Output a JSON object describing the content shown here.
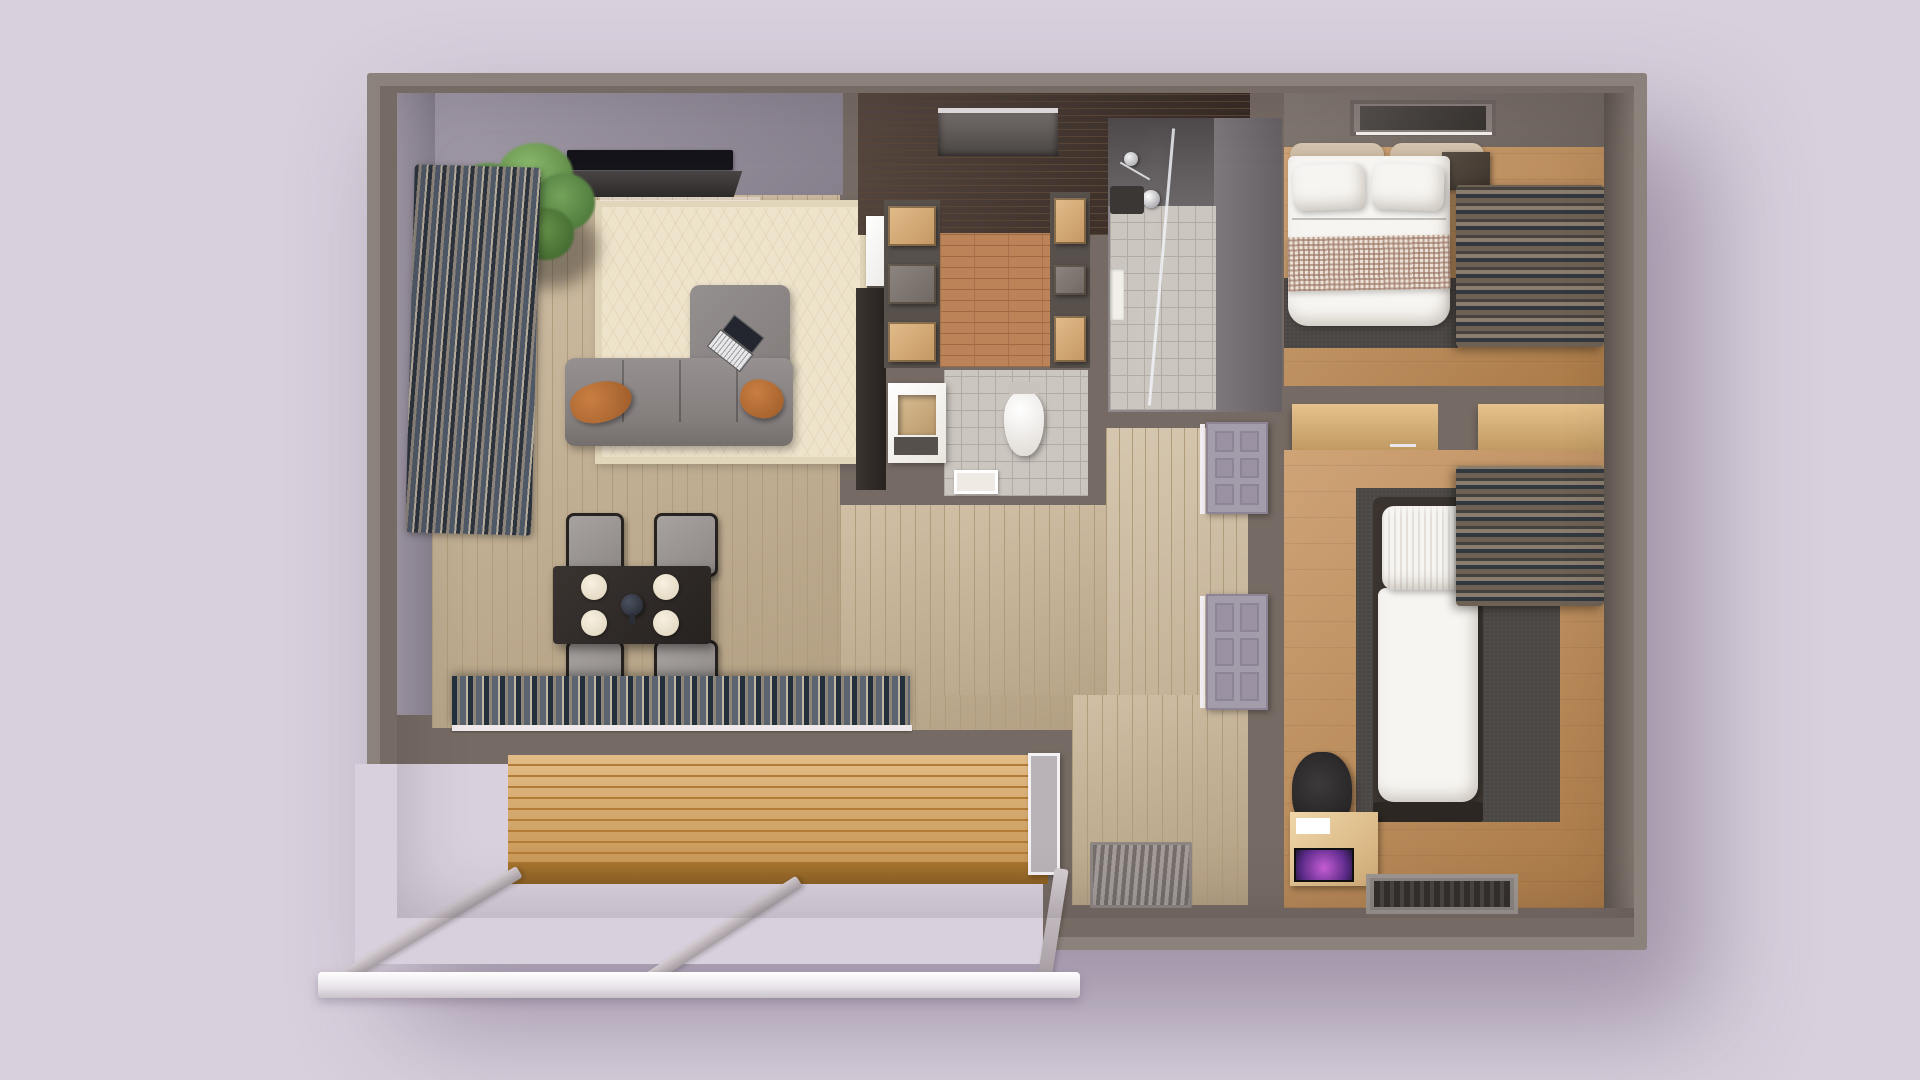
{
  "scene": {
    "type": "3d-floor-plan-render",
    "view": "top-down",
    "description": "Photorealistic top-down 3D render of a small apartment floor plan with wooden deck",
    "text_labels": []
  },
  "palette": {
    "bg": "#d8d0dc",
    "wall": "#766b64",
    "wallFaceLight": "#a59dab",
    "wallFaceDark": "#867f8c",
    "woodLight": "#c6b191",
    "woodLightLine": "#b09b7b",
    "woodDark": "#43332b",
    "woodDarkLine": "#5a4636",
    "brick": "#bc8258",
    "brickLine": "#9d6a41",
    "oak": "#c18a50",
    "tile": "#ccc6c0",
    "tileGrid": "#b2aba4",
    "rug": "#eee3cb",
    "rugBorder": "#e2d6ba",
    "sofa": "#8b8584",
    "pillowOrange": "#b06a33",
    "tableDark": "#2f2a27",
    "carpet": "#4b4744",
    "bedWhite": "#f7f5f1",
    "cushionTan": "#cfbda6",
    "deck": "#d9a55e",
    "deckGroove": "#b27c36",
    "railWhite": "#f5f2f6",
    "screenPurple": "#8b3fa8"
  },
  "rooms": [
    {
      "id": "living-dining",
      "name": "living and dining room"
    },
    {
      "id": "entry-hall",
      "name": "entry hall"
    },
    {
      "id": "kitchen",
      "name": "galley kitchen"
    },
    {
      "id": "shower-room",
      "name": "shower room"
    },
    {
      "id": "wc",
      "name": "toilet room"
    },
    {
      "id": "hallway",
      "name": "hallway"
    },
    {
      "id": "bedroom-master",
      "name": "master bedroom"
    },
    {
      "id": "bedroom-second",
      "name": "second bedroom"
    },
    {
      "id": "deck",
      "name": "outdoor wooden deck"
    }
  ],
  "furniture": {
    "living": [
      "potted plant",
      "wall tv",
      "media shelf",
      "area rug",
      "corner sofa",
      "orange pillows",
      "laptop",
      "dining table",
      "four chairs",
      "four plates",
      "teapot",
      "window curtains",
      "sliding door curtains"
    ],
    "kitchen": [
      "refrigerator",
      "wood cabinets",
      "counter",
      "overhead shelf"
    ],
    "shower": [
      "glass partition",
      "shower fixture",
      "wall niche",
      "bath mat"
    ],
    "wc": [
      "toilet",
      "vanity basin",
      "drain mat"
    ],
    "hallway": [
      "door panel",
      "door panel",
      "entry grate"
    ],
    "bedroom_master": [
      "double bed",
      "pillows",
      "checkered blanket",
      "headboard cushions",
      "nightstand",
      "ceiling light",
      "carpet",
      "curtains"
    ],
    "bedroom_second": [
      "single bed",
      "desk counter",
      "desk chair",
      "monitor desk",
      "rug",
      "floor vent",
      "curtains"
    ],
    "exterior": [
      "wood deck",
      "glass door panel",
      "railing posts",
      "railing bar"
    ]
  }
}
